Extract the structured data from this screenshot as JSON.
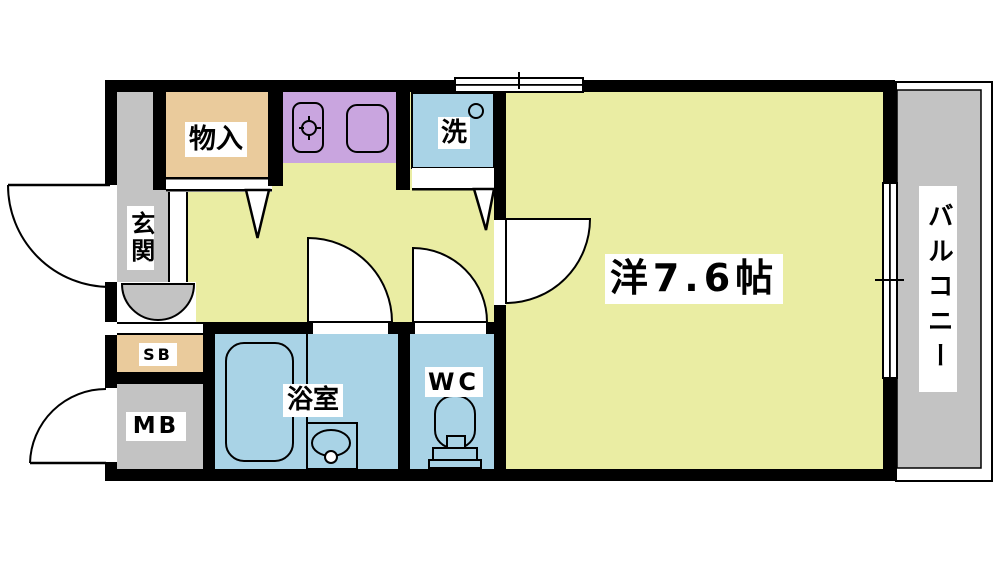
{
  "title": "1K apartment floor plan",
  "rooms": {
    "entrance": {
      "label": "玄関"
    },
    "storage": {
      "label": "物入"
    },
    "laundry": {
      "label": "洗"
    },
    "shoe_box": {
      "label": "SB"
    },
    "meter_box": {
      "label": "MB"
    },
    "bathroom": {
      "label": "浴室"
    },
    "toilet": {
      "label": "WC"
    },
    "main_room": {
      "label": "洋7.6帖"
    },
    "balcony": {
      "label": "バルコニー"
    }
  },
  "colors": {
    "wall": "#000000",
    "room_yellow": "#EAEDA3",
    "kitchen_purple": "#C9A5DF",
    "water_blue": "#A9D3E6",
    "closet_tan": "#EACB9C",
    "floor_gray": "#C3C3C3",
    "label_bg": "#FFFFFF"
  }
}
